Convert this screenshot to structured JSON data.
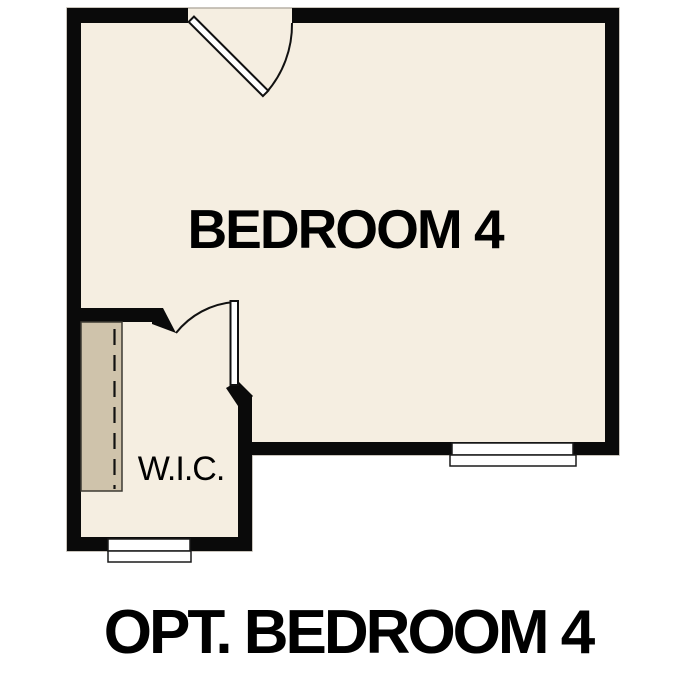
{
  "figure": {
    "type": "floor-plan",
    "room_label": "BEDROOM 4",
    "closet_label": "W.I.C.",
    "caption": "OPT. BEDROOM 4"
  },
  "colors": {
    "background": "#ffffff",
    "floor": "#f5eee1",
    "wall": "#0a0a0a",
    "shelf": "#cfc3ab",
    "line": "#111111",
    "text": "#000000"
  }
}
